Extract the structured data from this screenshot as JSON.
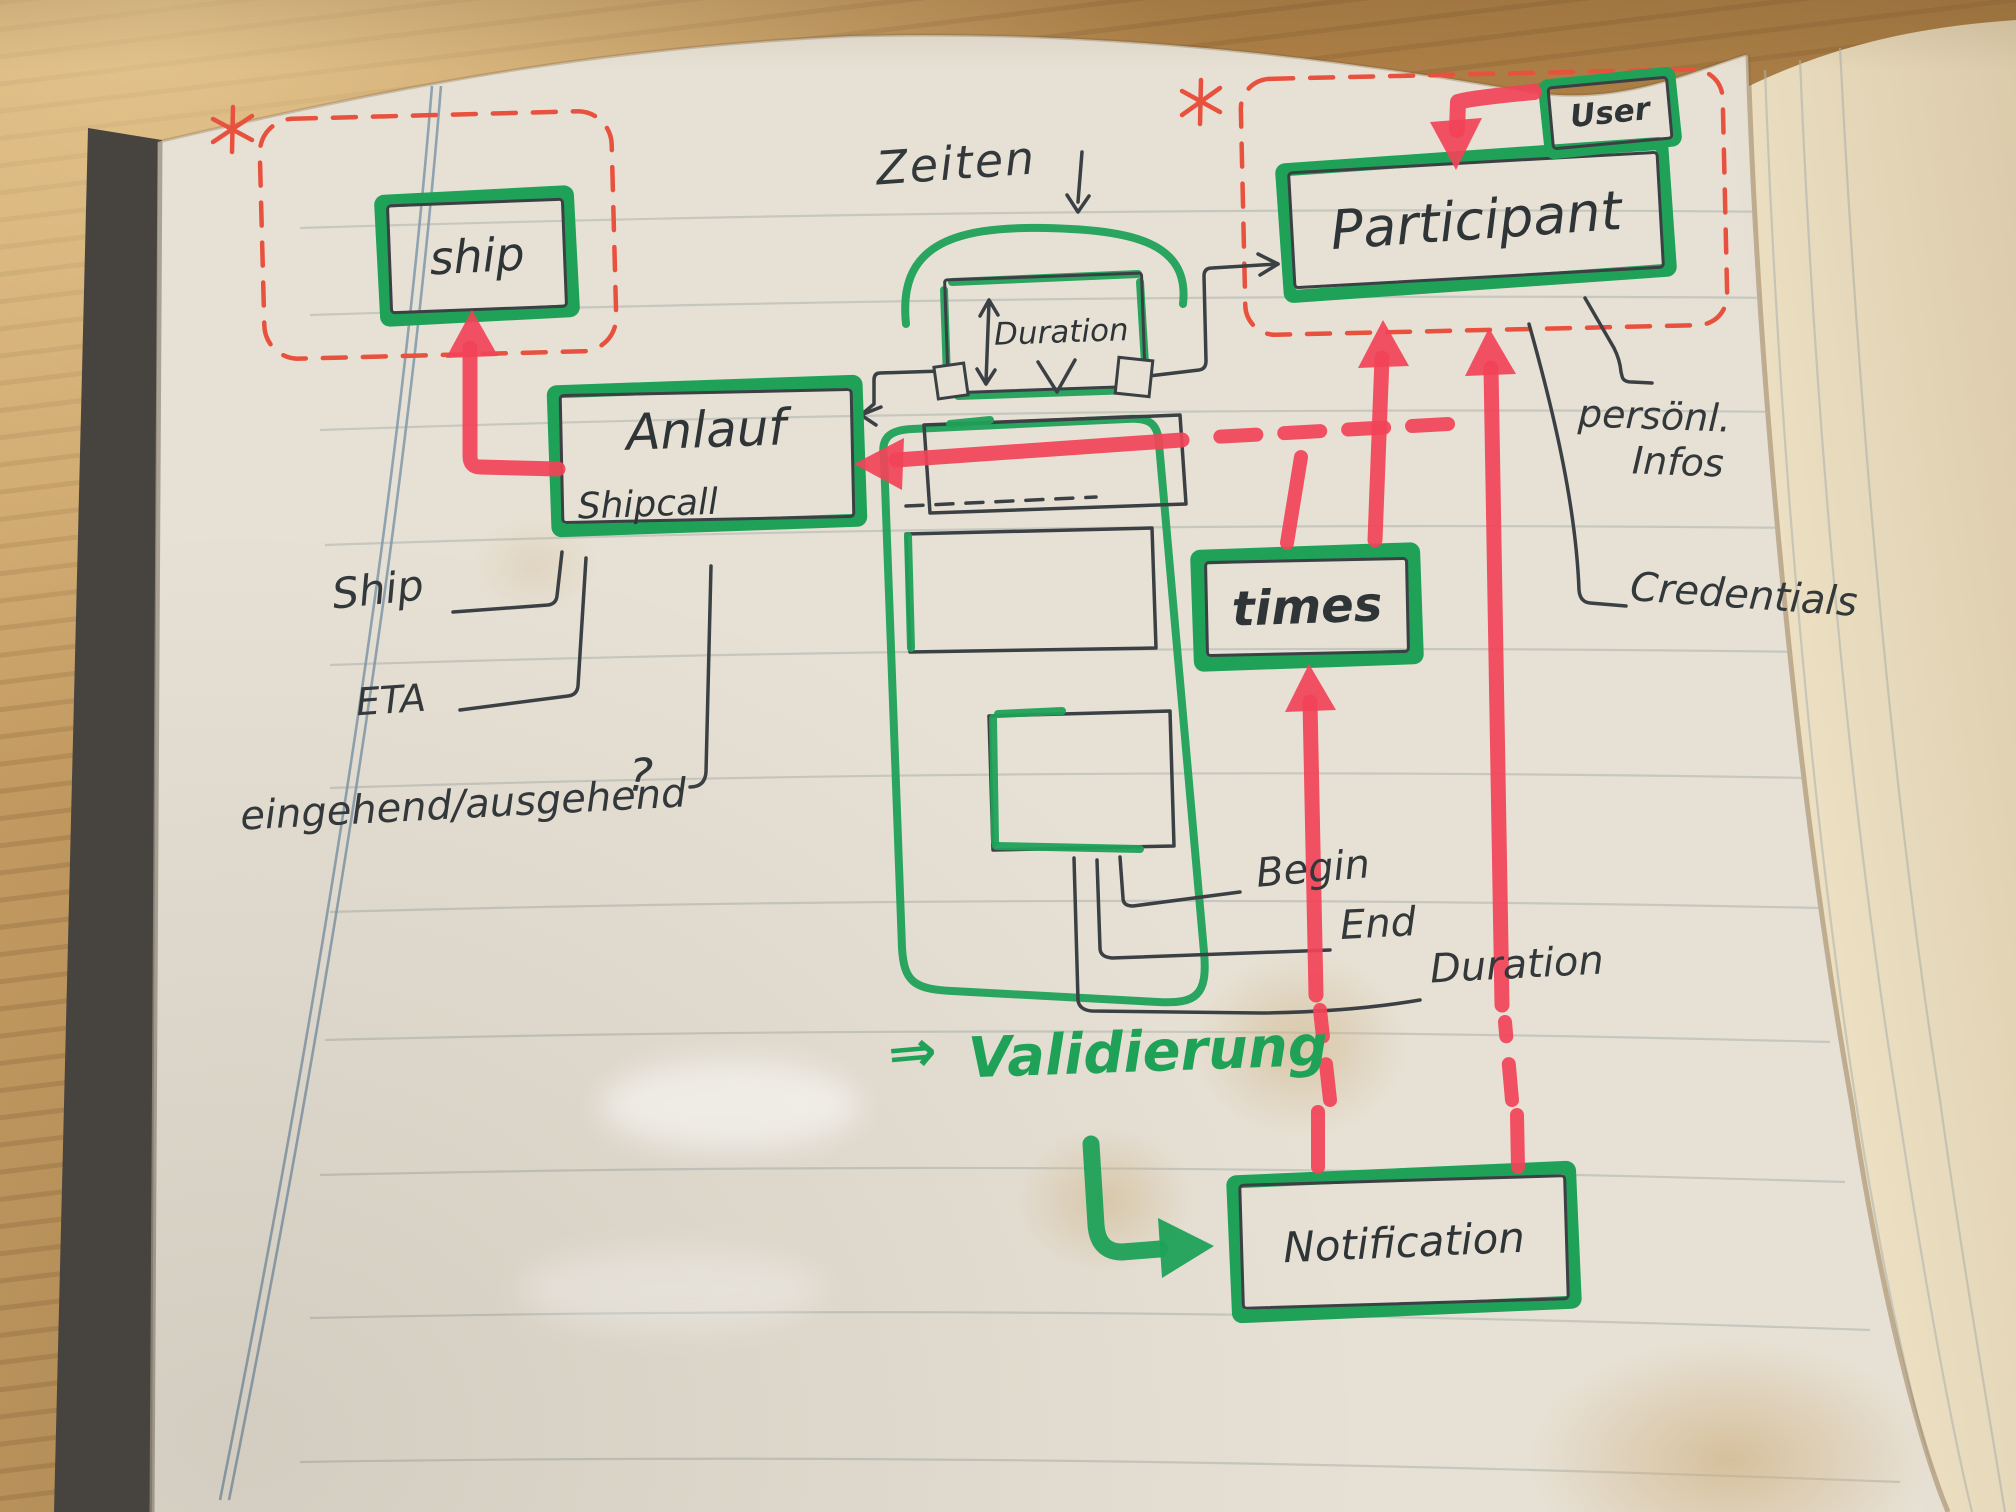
{
  "colors": {
    "page": "#e7e1d5",
    "wood": "#b98c52",
    "green": "#1fa158",
    "red_marker": "#f24358",
    "red_pen": "#e8513d",
    "ink": "#3b4044",
    "margin": "#7f96a8",
    "ruled": "#b0b6b0",
    "cover": "#474440",
    "stack": "#ecdfc2",
    "stain": "#cdb183"
  },
  "entities": {
    "ship": {
      "label": "ship"
    },
    "shipcall": {
      "label": "Anlauf",
      "sublabel": "Shipcall"
    },
    "duration": {
      "label": "Duration"
    },
    "participant": {
      "label": "Participant"
    },
    "user": {
      "label": "User"
    },
    "times": {
      "label": "times"
    },
    "notification": {
      "label": "Notification"
    }
  },
  "annotations": {
    "zeiten": "Zeiten",
    "ship_attr": "Ship",
    "eta": "ETA",
    "inout": "eingehend/ausgehend",
    "question_mark": "?",
    "begin": "Begin",
    "end": "End",
    "duration_attr": "Duration",
    "personal_line1": "persönl.",
    "personal_line2": "Infos",
    "credentials": "Credentials",
    "validierung_arrow": "⇒",
    "validierung": "Validierung"
  }
}
